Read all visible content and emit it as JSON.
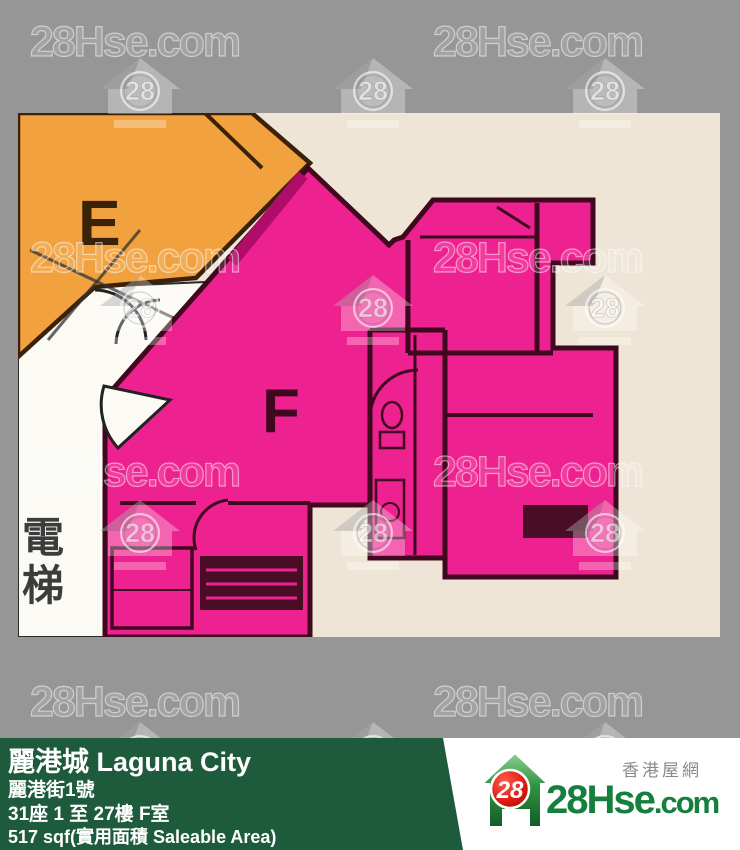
{
  "page": {
    "background": "#969696"
  },
  "floorplan": {
    "unit_e_label": "E",
    "unit_f_label": "F",
    "lift_chars": [
      "電",
      "梯"
    ],
    "colors": {
      "paper": "#eee5d6",
      "lobby_white": "#fbfaf5",
      "unit_e_fill": "#f1a13e",
      "unit_e_wall": "#3b2107",
      "unit_f_fill": "#ee2190",
      "unit_f_wall": "#40081f",
      "party_wall_band": "#b00c69",
      "fixture_dark": "#4a0d26"
    }
  },
  "watermark": {
    "text": "28Hse.com",
    "badge": "28",
    "text_positions": [
      {
        "x": 30,
        "y": 22
      },
      {
        "x": 433,
        "y": 22
      },
      {
        "x": 30,
        "y": 238
      },
      {
        "x": 433,
        "y": 238
      },
      {
        "x": 30,
        "y": 452
      },
      {
        "x": 433,
        "y": 452
      },
      {
        "x": 30,
        "y": 682
      },
      {
        "x": 433,
        "y": 682
      }
    ],
    "icon_positions": [
      {
        "x": 100,
        "y": 58
      },
      {
        "x": 333,
        "y": 58
      },
      {
        "x": 565,
        "y": 58
      },
      {
        "x": 100,
        "y": 275
      },
      {
        "x": 333,
        "y": 275
      },
      {
        "x": 565,
        "y": 275
      },
      {
        "x": 100,
        "y": 500
      },
      {
        "x": 333,
        "y": 500
      },
      {
        "x": 565,
        "y": 500
      },
      {
        "x": 100,
        "y": 722
      },
      {
        "x": 333,
        "y": 722
      },
      {
        "x": 565,
        "y": 722
      }
    ]
  },
  "footer": {
    "bar_color": "#1d5b3c",
    "title": "麗港城 Laguna City",
    "address": "麗港街1號",
    "unit": "31座 1 至 27樓 F室",
    "area": "517 sqf(實用面積 Saleable Area)"
  },
  "logo": {
    "brand_main": "28Hse",
    "brand_suffix": ".com",
    "badge": "28",
    "tagline": "香港屋網"
  }
}
